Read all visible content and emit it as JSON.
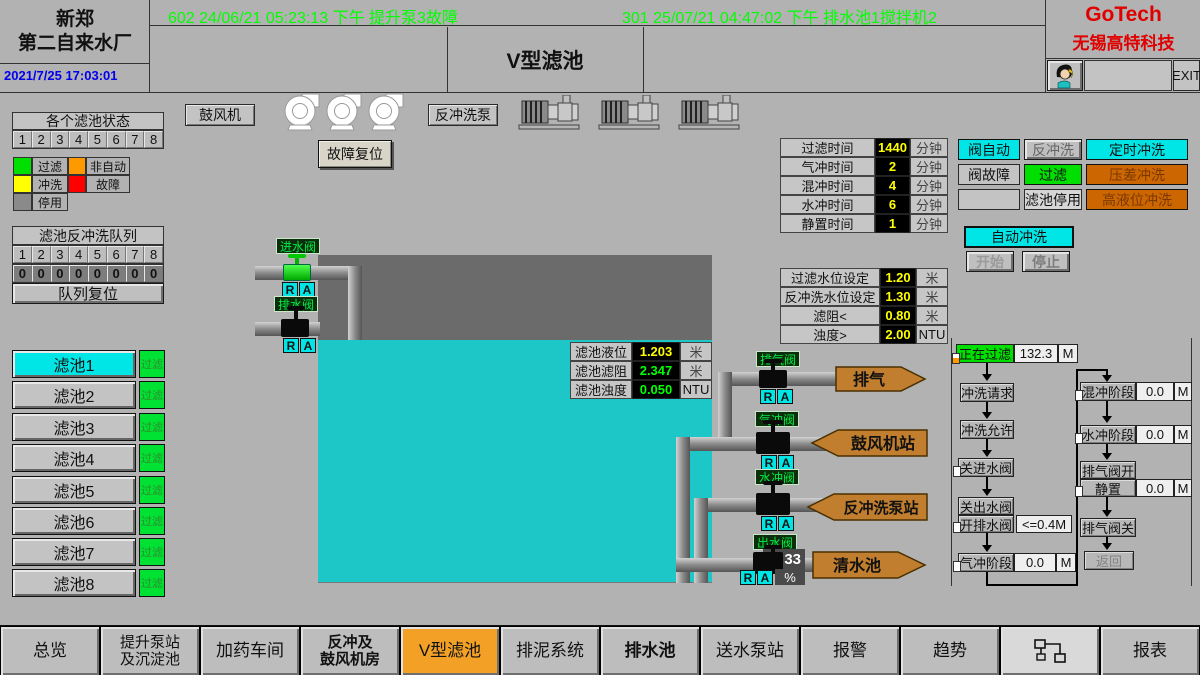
{
  "header": {
    "plant_line1": "新郑",
    "plant_line2": "第二自来水厂",
    "datetime": "2021/7/25 17:03:01",
    "alarm1": "602 24/06/21 05:23:13 下午 提升泵3故障",
    "alarm2": "301 25/07/21 04:47:02 下午 排水池1搅拌机2",
    "title": "V型滤池",
    "brand1": "GoTech",
    "brand2": "无锡高特科技",
    "exit": "EXIT"
  },
  "colors": {
    "cyan": "#00e5e5",
    "green": "#00e000",
    "orange": "#cc6600",
    "nav_active": "#f2a126",
    "alarm_text": "#00ff00",
    "datetime_text": "#0000ee",
    "brand_red": "#e00000",
    "water": "#1dc7c7",
    "value_yellow": "#ffff00",
    "value_green": "#00ff00"
  },
  "status_panel": {
    "title": "各个滤池状态",
    "cells": [
      "1",
      "2",
      "3",
      "4",
      "5",
      "6",
      "7",
      "8"
    ],
    "legend": [
      {
        "label": "过滤",
        "color": "#00e000"
      },
      {
        "label": "非自动",
        "color": "#ff9900"
      },
      {
        "label": "冲洗",
        "color": "#ffff00"
      },
      {
        "label": "故障",
        "color": "#ff0000"
      },
      {
        "label": "停用",
        "color": "#8a8a8a"
      }
    ]
  },
  "queue_panel": {
    "title": "滤池反冲洗队列",
    "cells": [
      "1",
      "2",
      "3",
      "4",
      "5",
      "6",
      "7",
      "8"
    ],
    "values": [
      "0",
      "0",
      "0",
      "0",
      "0",
      "0",
      "0",
      "0"
    ],
    "reset": "队列复位"
  },
  "filters": [
    {
      "name": "滤池1",
      "status": "过滤"
    },
    {
      "name": "滤池2",
      "status": "过滤"
    },
    {
      "name": "滤池3",
      "status": "过滤"
    },
    {
      "name": "滤池4",
      "status": "过滤"
    },
    {
      "name": "滤池5",
      "status": "过滤"
    },
    {
      "name": "滤池6",
      "status": "过滤"
    },
    {
      "name": "滤池7",
      "status": "过滤"
    },
    {
      "name": "滤池8",
      "status": "过滤"
    }
  ],
  "equipment": {
    "blower": "鼓风机",
    "fault_reset": "故障复位",
    "backwash_pump": "反冲洗泵"
  },
  "timer_table": [
    {
      "label": "过滤时间",
      "value": "1440",
      "unit": "分钟"
    },
    {
      "label": "气冲时间",
      "value": "2",
      "unit": "分钟"
    },
    {
      "label": "混冲时间",
      "value": "4",
      "unit": "分钟"
    },
    {
      "label": "水冲时间",
      "value": "6",
      "unit": "分钟"
    },
    {
      "label": "静置时间",
      "value": "1",
      "unit": "分钟"
    }
  ],
  "setting_table": [
    {
      "label": "过滤水位设定",
      "value": "1.20",
      "unit": "米"
    },
    {
      "label": "反冲洗水位设定",
      "value": "1.30",
      "unit": "米"
    },
    {
      "label": "滤阻<",
      "value": "0.80",
      "unit": "米"
    },
    {
      "label": "浊度>",
      "value": "2.00",
      "unit": "NTU"
    }
  ],
  "mode_grid": {
    "valve_auto": "阀自动",
    "backwash": "反冲洗",
    "timed_wash": "定时冲洗",
    "valve_fault": "阀故障",
    "filtering": "过滤",
    "diff_pressure_wash": "压差冲洗",
    "filter_disabled": "滤池停用",
    "high_level_wash": "高液位冲洗"
  },
  "auto_wash": {
    "title": "自动冲洗",
    "start": "开始",
    "stop": "停止"
  },
  "tank_table": [
    {
      "label": "滤池液位",
      "value": "1.203",
      "unit": "米"
    },
    {
      "label": "滤池滤阻",
      "value": "2.347",
      "unit": "米"
    },
    {
      "label": "滤池浊度",
      "value": "0.050",
      "unit": "NTU"
    }
  ],
  "valves": {
    "inlet": "进水阀",
    "drain": "排水阀",
    "exhaust": "排气阀",
    "air": "气冲阀",
    "water": "水冲阀",
    "outlet": "出水阀",
    "r": "R",
    "a": "A",
    "outlet_opening": "33",
    "outlet_unit": "%"
  },
  "arrows": {
    "exhaust": "排气",
    "blower_station": "鼓风机站",
    "backwash_station": "反冲洗泵站",
    "clear_well": "清水池"
  },
  "flow": {
    "filtering_label": "正在过滤",
    "filtering_value": "132.3",
    "filtering_unit": "M",
    "wash_request": "冲洗请求",
    "wash_allow": "冲洗允许",
    "close_inlet": "关进水阀",
    "close_outlet": "关出水阀",
    "open_drain": "开排水阀",
    "drain_cond": "<=0.4M",
    "air_label": "气冲阶段",
    "air_value": "0.0",
    "air_unit": "M",
    "mix_label": "混冲阶段",
    "mix_value": "0.0",
    "mix_unit": "M",
    "water_label": "水冲阶段",
    "water_value": "0.0",
    "water_unit": "M",
    "exhaust_open": "排气阀开",
    "rest_label": "静置",
    "rest_value": "0.0",
    "rest_unit": "M",
    "exhaust_close": "排气阀关",
    "back": "返回"
  },
  "nav": [
    {
      "line1": "总览"
    },
    {
      "line1": "提升泵站",
      "line2": "及沉淀池"
    },
    {
      "line1": "加药车间"
    },
    {
      "line1": "反冲及",
      "line2": "鼓风机房"
    },
    {
      "line1": "V型滤池"
    },
    {
      "line1": "排泥系统"
    },
    {
      "line1": "排水池"
    },
    {
      "line1": "送水泵站"
    },
    {
      "line1": "报警"
    },
    {
      "line1": "趋势"
    },
    {
      "line1": ""
    },
    {
      "line1": "报表"
    }
  ]
}
